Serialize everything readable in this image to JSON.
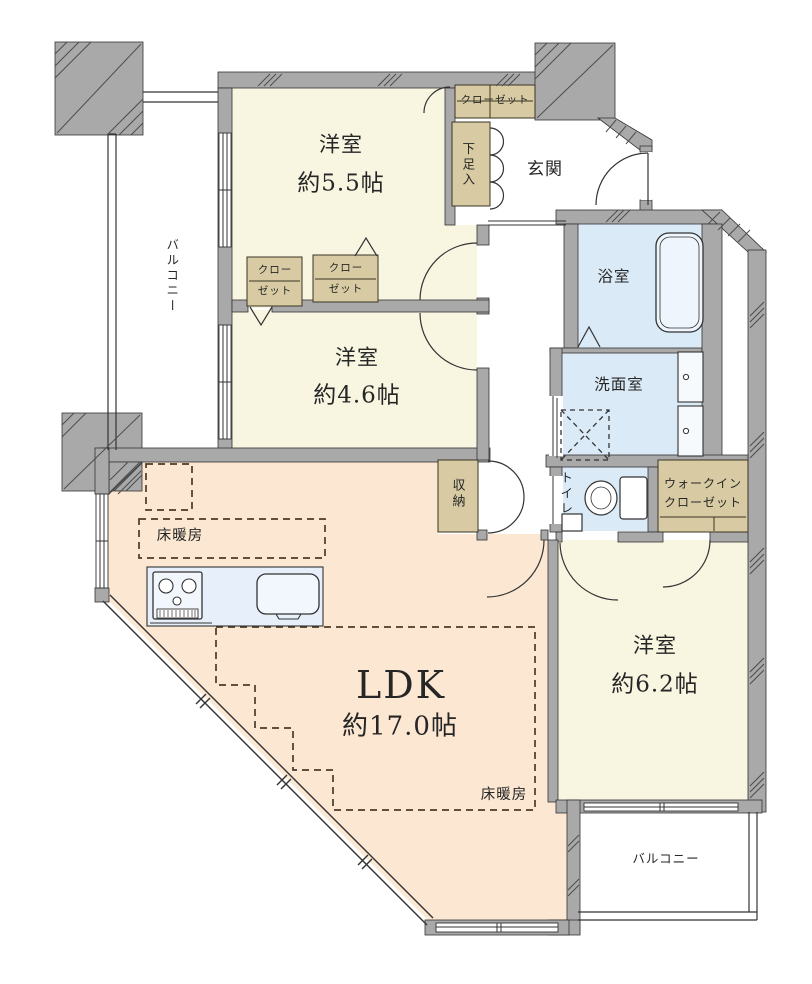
{
  "floor_plan": {
    "rooms": {
      "bedroom_top": {
        "label": "洋室",
        "area": "約5.5帖"
      },
      "bedroom_mid": {
        "label": "洋室",
        "area": "約4.6帖"
      },
      "bedroom_right": {
        "label": "洋室",
        "area": "約6.2帖"
      },
      "ldk": {
        "label": "LDK",
        "area": "約17.0帖"
      },
      "entrance": {
        "label": "玄関"
      },
      "bathroom": {
        "label": "浴室"
      },
      "washroom": {
        "label": "洗面室"
      },
      "toilet": {
        "label": "トイレ"
      }
    },
    "storage": {
      "storage_closet": {
        "label": "収納"
      },
      "shoe_cabinet": {
        "label": "下足入"
      },
      "closet_entry": {
        "label": "クローゼット"
      },
      "closet_a": {
        "line1": "クロー",
        "line2": "ゼット"
      },
      "closet_b": {
        "line1": "クロー",
        "line2": "ゼット"
      },
      "walk_in_closet": {
        "line1": "ウォークイン",
        "line2": "クローゼット"
      }
    },
    "features": {
      "floor_heating_kitchen": {
        "label": "床暖房"
      },
      "floor_heating_living": {
        "label": "床暖房"
      }
    },
    "balconies": {
      "left": {
        "label": "バルコニー"
      },
      "bottom": {
        "label": "バルコニー"
      }
    }
  },
  "colors": {
    "room_cream": "#f8f5e1",
    "ldk_peach": "#fbe7d2",
    "wet_blue": "#daeaf6",
    "closet_tan": "#d8cba3",
    "wall_gray": "#a9a9a9",
    "fixture_blue": "#eef5fc",
    "counter_blue": "#e7f0fa",
    "line_dark": "#2e2e2e",
    "heat_dash": "#4a3b28",
    "text_ink": "#262626"
  }
}
